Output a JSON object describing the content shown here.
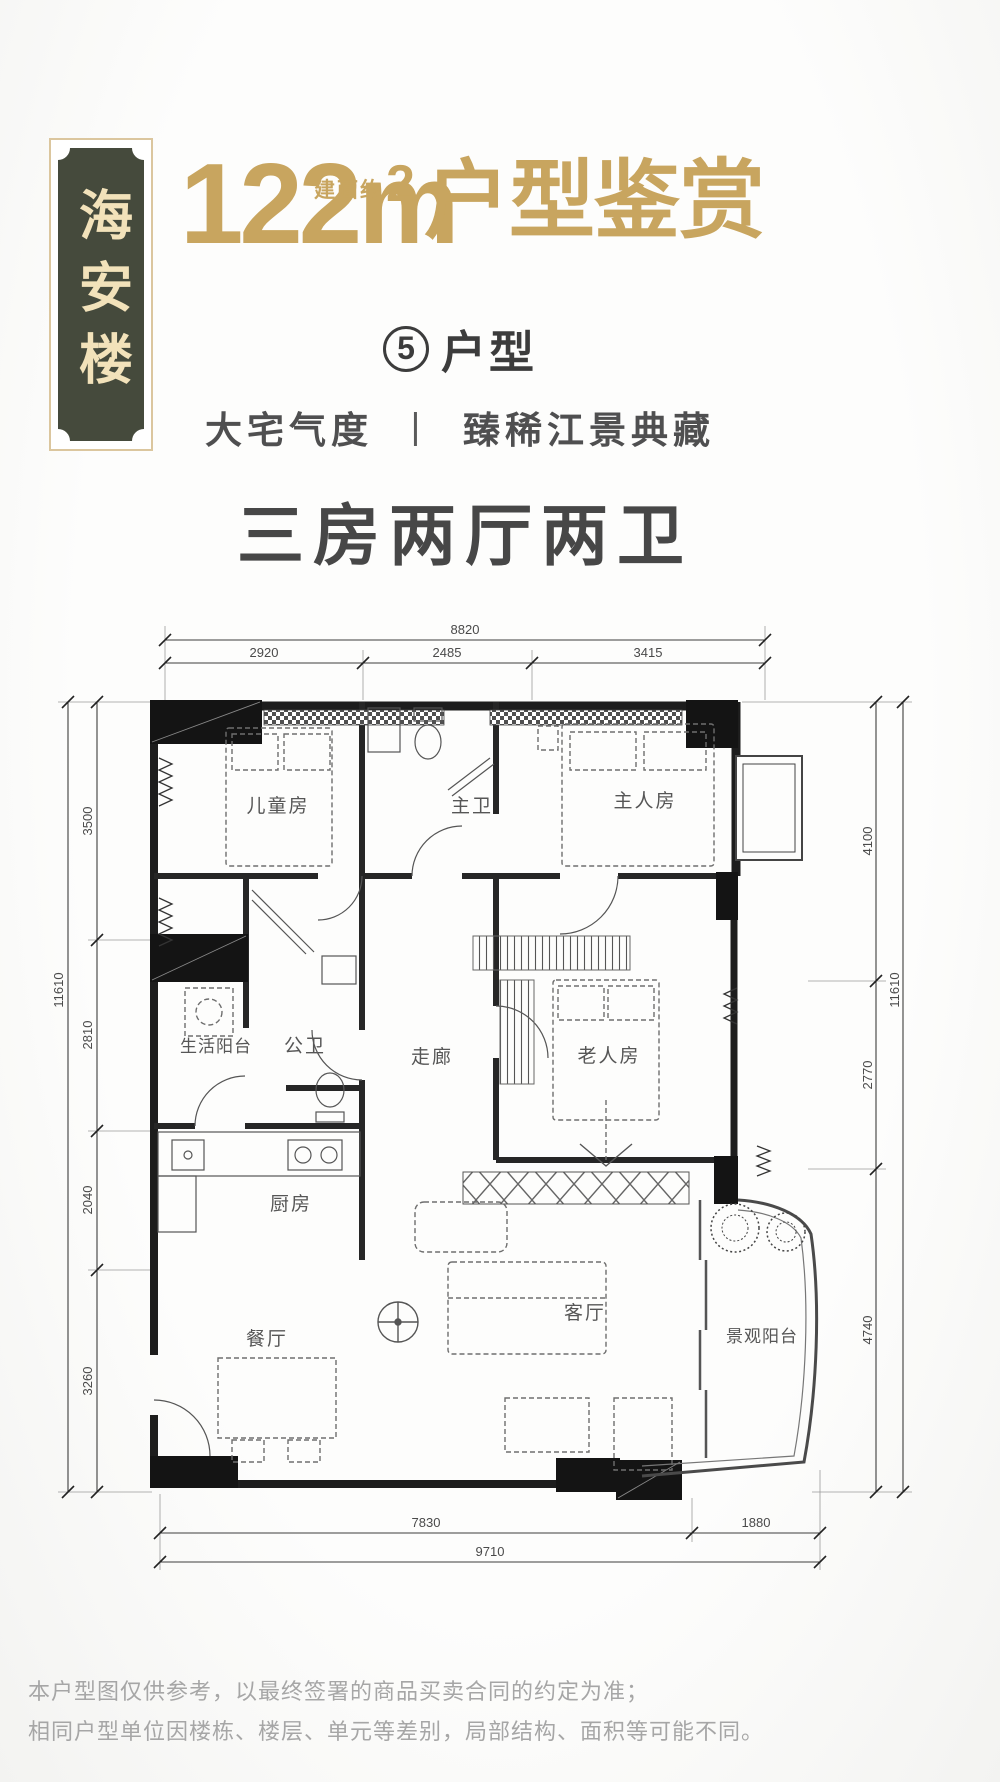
{
  "badge": {
    "name": "海安楼"
  },
  "header": {
    "area_value": "122m",
    "area_sup": "2",
    "area_prefix": "建面约",
    "title_suffix": "户型鉴赏",
    "unit_number": "5",
    "unit_label": "户型",
    "tagline_left": "大宅气度",
    "tagline_divider": "丨",
    "tagline_right": "臻稀江景典藏",
    "layout_title": "三房两厅两卫"
  },
  "floorplan": {
    "rooms": [
      {
        "id": "childrens-room",
        "label": "儿童房"
      },
      {
        "id": "master-bath",
        "label": "主卫"
      },
      {
        "id": "master-bedroom",
        "label": "主人房"
      },
      {
        "id": "living-balcony",
        "label": "生活阳台"
      },
      {
        "id": "public-bath",
        "label": "公卫"
      },
      {
        "id": "corridor",
        "label": "走廊"
      },
      {
        "id": "elder-room",
        "label": "老人房"
      },
      {
        "id": "kitchen",
        "label": "厨房"
      },
      {
        "id": "dining-room",
        "label": "餐厅"
      },
      {
        "id": "living-room",
        "label": "客厅"
      },
      {
        "id": "view-balcony",
        "label": "景观阳台"
      }
    ],
    "dims": {
      "top_total": "8820",
      "top_segments": [
        "2920",
        "2485",
        "3415"
      ],
      "left_total": "11610",
      "left_segments": [
        "3500",
        "2810",
        "2040",
        "3260"
      ],
      "right_total": "11610",
      "right_segments": [
        "4100",
        "2770",
        "4740"
      ],
      "bottom_segments": [
        "7830",
        "1880"
      ],
      "bottom_total": "9710"
    }
  },
  "disclaimer": {
    "line1": "本户型图仅供参考，以最终签署的商品买卖合同的约定为准；",
    "line2": "相同户型单位因楼栋、楼层、单元等差别，局部结构、面积等可能不同。"
  },
  "colors": {
    "gold": "#c8a55f",
    "plaque": "#454a3c",
    "plaque_text": "#f2e2ba",
    "heading": "#474747",
    "wall": "#1d1d1d",
    "dim": "#4a4a4a",
    "room_label": "#565656",
    "disclaimer": "#a6a6a6"
  }
}
